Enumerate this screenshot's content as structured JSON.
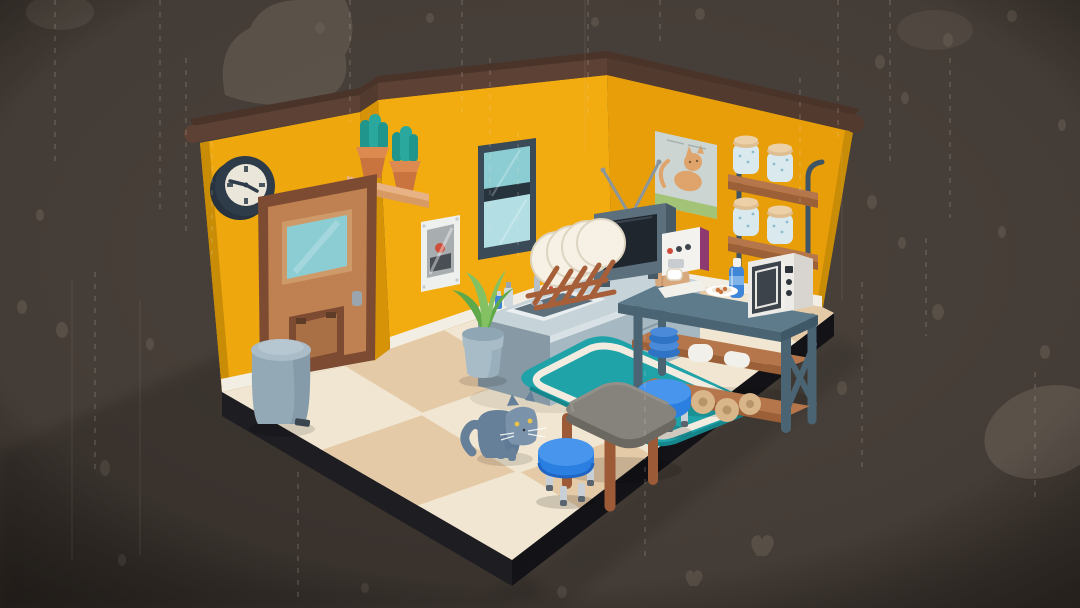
{
  "meta": {
    "scene_label": "Isometric cozy kitchen room with a cat, rendered in a dark rainy backdrop",
    "canvas": {
      "width": 1080,
      "height": 608
    }
  },
  "palette": {
    "bg_mid": "#4a423b",
    "bg_edge": "#332d28",
    "smoke": "#6f665c",
    "pebble": "#6f665a",
    "rain": "#eadfd2",
    "trim": "#5d4134",
    "trim_top": "#4a342a",
    "trim_dark": "#523a2e",
    "wall_a": "#efa70e",
    "wall_b": "#f3ac10",
    "wall_c": "#e89e08",
    "wall_edge": "#c98c06",
    "wall_return": "#d69307",
    "baseboard": "#f3eee3",
    "plinth_l": "#1d1d22",
    "plinth_r": "#131317",
    "floor_light": "#f1e6d1",
    "floor_dark": "#e5caa7",
    "door_frame": "#7d4b31",
    "door_face": "#bf8152",
    "door_face_dark": "#aa7045",
    "door_inner": "#cf9a6a",
    "hinge": "#5c3b27",
    "glass": "#8ccdd3",
    "glass_light": "#b3dfe4",
    "handle_gray": "#9aa5ad",
    "clock_body": "#2e3c49",
    "clock_body_dark": "#26323e",
    "clock_face": "#ebe6da",
    "shelf_wood": "#d79a65",
    "shelf_wood_top": "#e7b285",
    "pot_terra": "#c9733f",
    "pot_terra_light": "#dd8a50",
    "cactus": "#1f958c",
    "cactus_light": "#2aa89e",
    "notice_white": "#eef0ee",
    "notice_gray": "#a8adaf",
    "notice_dark": "#4a4f55",
    "notice_red": "#cc4f3b",
    "screw": "#c6cbcd",
    "win_frame": "#3a4a56",
    "win_frame_dark": "#27343e",
    "counter_top": "#c6d3d9",
    "counter_edge": "#d8e2e6",
    "counter_front": "#a6b8c2",
    "counter_side": "#8799a5",
    "counter_handle": "#eef2f3",
    "sink_rim": "#e9eef0",
    "sink_in": "#5d707c",
    "faucet": "#b6c0c6",
    "soap_gray": "#cfd8dc",
    "rack_wood": "#a65f38",
    "plate_white": "#f6f1e4",
    "plate_shade": "#ddd5c2",
    "plate_inner": "#efe6d8",
    "tv_body": "#5b6f7d",
    "tv_dark": "#495a67",
    "tv_screen": "#20262e",
    "antenna": "#8a959c",
    "bag_tan": "#d7a97c",
    "bag_dark": "#c69063",
    "poster_bg": "#cdd5d3",
    "poster_cat": "#dfa46b",
    "poster_grass": "#a3c376",
    "poster_line": "#96a29c",
    "poster_border": "#bfc9c7",
    "jar_glass": "#d9e9ee",
    "jar_speck": "#8fbccb",
    "jar_lid": "#ecd0a8",
    "jar_lid_dark": "#dfbe92",
    "rail_metal": "#3f5464",
    "ptable_top": "#5d7b8b",
    "ptable_frame": "#4a6474",
    "ptable_frame_dark": "#3f5868",
    "ptable_shelf": "#9c6038",
    "ptable_shelf_top": "#b4764a",
    "coffee_white": "#f4f2ee",
    "coffee_magenta": "#8e3a70",
    "coffee_dark": "#3e444c",
    "coffee_red": "#d04a3a",
    "coffee_tray": "#c9ccd0",
    "bottle_blue": "#3f86d8",
    "bottle_light": "#7fb3e8",
    "micro_white": "#edebe7",
    "micro_side": "#d8d5d0",
    "micro_door": "#3c434b",
    "micro_btn": "#2e343b",
    "bowl_blue": "#2f74c4",
    "bowl_blue_light": "#4a8ad8",
    "white_item": "#f2f0ea",
    "roll_tan": "#d9b58a",
    "roll_dark": "#b8946a",
    "rug_teal": "#1fa2a8",
    "rug_teal_dark": "#15868c",
    "rug_white": "#f2ece0",
    "table_top": "#86837c",
    "table_top_light": "#93908a",
    "table_side": "#6b6862",
    "leg_brown": "#9c5a36",
    "stool_blue": "#2b7fe0",
    "stool_blue_light": "#4795ec",
    "stool_blue_dark": "#1f66c4",
    "stool_leg": "#c9d0d5",
    "stool_leg_dark": "#5a646e",
    "plantpot": "#a8bcc8",
    "plantpot_dark": "#8fa6b4",
    "leaf": "#83c163",
    "leaf_dark": "#5fa94a",
    "trash_body": "#94a9b6",
    "trash_lid": "#a9bcc7",
    "trash_lid_top": "#b7c7d1",
    "trash_dark": "#7d93a2",
    "pedal": "#3a454e",
    "cat_body": "#66809a",
    "cat_dark": "#57718b",
    "cat_light": "#7b93aa",
    "cat_eye": "#e8c24a",
    "cat_pupil": "#2c3440",
    "white": "#ffffff"
  },
  "objects": {
    "background": {
      "label": "Dark rainy backdrop with smoke and debris"
    },
    "room": {
      "label": "Isometric room shell with mustard walls and checkered floor"
    },
    "clock": {
      "label": "Round wall clock"
    },
    "door": {
      "label": "Wooden door with window and cat flap"
    },
    "trash_can": {
      "label": "Blue-gray pedal trash can"
    },
    "cacti_shelf": {
      "label": "Wall shelf with two potted cacti"
    },
    "wall_notice": {
      "label": "Small white wall notice"
    },
    "window": {
      "label": "Tall window with teal glass"
    },
    "sink_counter": {
      "label": "Kitchen sink counter with faucet"
    },
    "dish_rack": {
      "label": "Wooden dish drying rack with plates"
    },
    "tv": {
      "label": "Retro television with antennas"
    },
    "paper_bag": {
      "label": "Paper grocery bag"
    },
    "cat_poster": {
      "label": "Poster of an orange cat"
    },
    "jar_shelf": {
      "label": "Two-tier shelf with glass jars"
    },
    "prep_table": {
      "label": "Prep table with coffee machine and microwave"
    },
    "coffee_machine": {
      "label": "White espresso machine"
    },
    "water_bottle": {
      "label": "Blue water bottle"
    },
    "snack_plate": {
      "label": "Plate with cookies"
    },
    "microwave": {
      "label": "White microwave oven"
    },
    "bowl_stack": {
      "label": "Stack of blue bowls"
    },
    "paper_rolls": {
      "label": "Rolls of kraft paper"
    },
    "rug": {
      "label": "Teal rug with white border"
    },
    "dining_table": {
      "label": "Gray dining table with wooden legs"
    },
    "stool_front": {
      "label": "Blue stool (front)"
    },
    "stool_back": {
      "label": "Blue stool (back)"
    },
    "potted_plant": {
      "label": "Potted green plant"
    },
    "cat": {
      "label": "Gray cat with yellow eyes"
    }
  }
}
